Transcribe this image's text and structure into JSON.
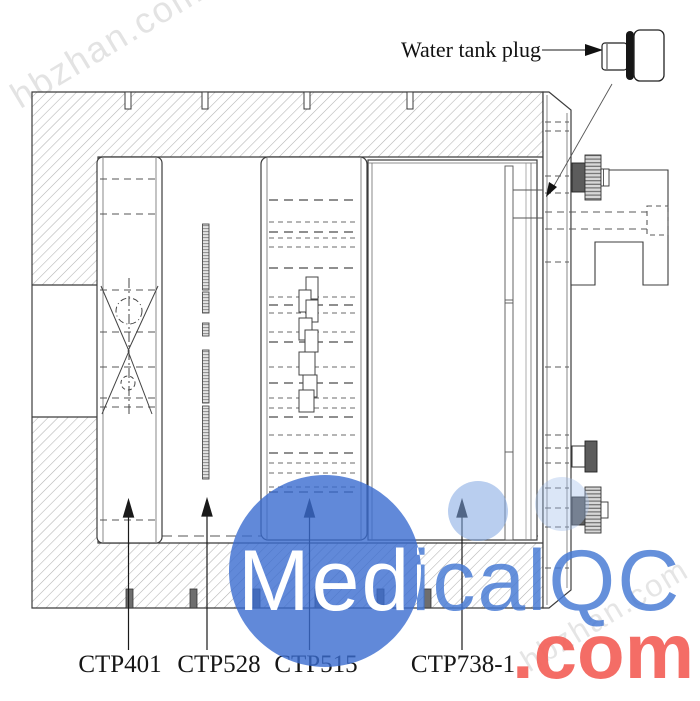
{
  "callout": {
    "label": "Water tank plug"
  },
  "module_labels": [
    {
      "id": "ctp401",
      "label": "CTP401"
    },
    {
      "id": "ctp528",
      "label": "CTP528"
    },
    {
      "id": "ctp515",
      "label": "CTP515"
    },
    {
      "id": "ctp738-1",
      "label": "CTP738-1"
    }
  ],
  "watermarks": {
    "brand": "MedicalQC",
    "brand_suffix": ".com",
    "corner": "hbzhan.com",
    "colors": {
      "brand_blue": "#4478d4",
      "brand_red": "#f4635b",
      "circle_blue": "#3a6cd0",
      "light_circle_blue": "#80a5e2",
      "corner_gray": "#cdcdcd"
    }
  }
}
